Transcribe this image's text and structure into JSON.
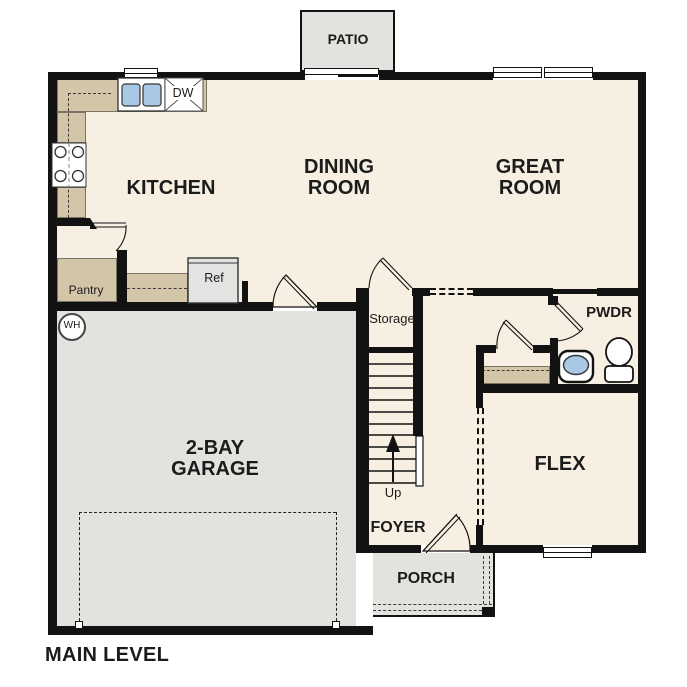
{
  "title": "MAIN LEVEL",
  "rooms": {
    "patio": "PATIO",
    "kitchen": "KITCHEN",
    "dining": "DINING ROOM",
    "great_room": "GREAT ROOM",
    "pantry": "Pantry",
    "storage": "Storage",
    "powder": "PWDR",
    "garage": "2-BAY GARAGE",
    "flex": "FLEX",
    "foyer": "FOYER",
    "porch": "PORCH"
  },
  "fixtures": {
    "refrigerator": "Ref",
    "dishwasher": "DW",
    "water_heater": "WH",
    "stairs_direction": "Up"
  },
  "colors": {
    "floor": "#f7f0e2",
    "exterior_area": "#e4e2df",
    "counter": "#d2c5a8",
    "wall": "#121212",
    "plumbing_blue": "#a9c8e6"
  }
}
